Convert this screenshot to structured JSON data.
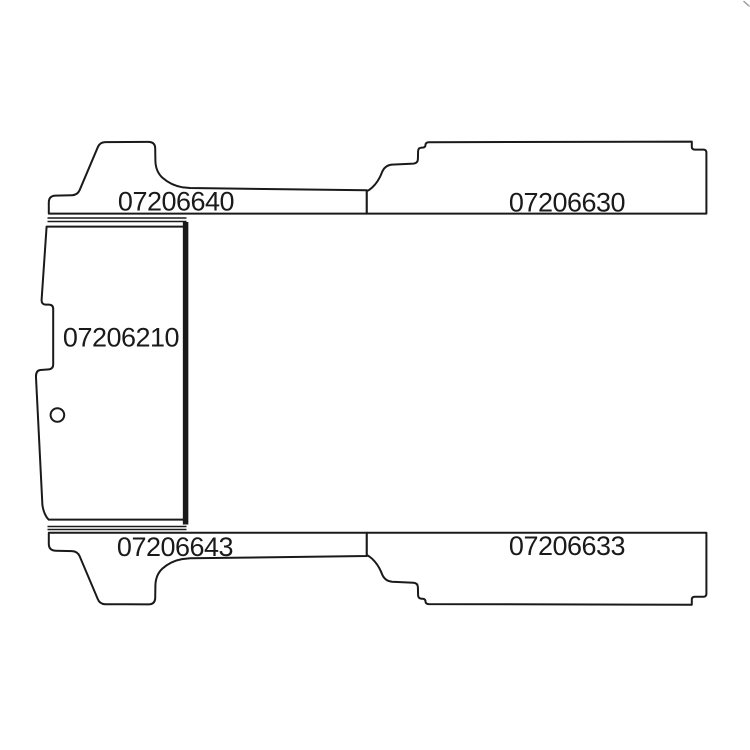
{
  "colors": {
    "background": "#ffffff",
    "line": "#1a1a1a",
    "text": "#1a1a1a",
    "artifact": "#9a9a9a"
  },
  "parts": [
    {
      "id": "top-left-strip",
      "label": "07206640"
    },
    {
      "id": "top-right-panel",
      "label": "07206630"
    },
    {
      "id": "main-left-panel",
      "label": "07206210"
    },
    {
      "id": "bottom-left-strip",
      "label": "07206643"
    },
    {
      "id": "bottom-right-panel",
      "label": "07206633"
    }
  ]
}
